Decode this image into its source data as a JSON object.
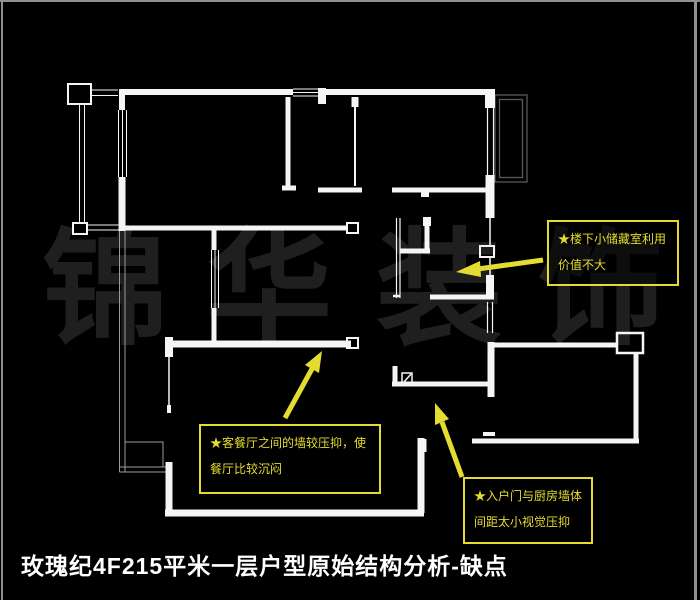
{
  "title": "玫瑰纪4F215平米一层户型原始结构分析-缺点",
  "watermark": {
    "text": "锦华装饰",
    "chars": [
      "锦",
      "华",
      "装",
      "饰"
    ]
  },
  "annotations": [
    {
      "lines": [
        "★楼下小储藏室利用",
        "价值不大"
      ]
    },
    {
      "lines": [
        "★客餐厅之间的墙较压抑，使",
        "餐厅比较沉闷"
      ]
    },
    {
      "lines": [
        "★入户门与厨房墙体",
        "间距太小视觉压抑"
      ]
    }
  ],
  "colors": {
    "background": "#000000",
    "wall_line": "#f5f5f5",
    "annotation_yellow": "#e5dc31",
    "watermark_gray": "#1f1f1f",
    "frame_gray": "#8f8f8f",
    "balcony_gray": "#585858"
  }
}
